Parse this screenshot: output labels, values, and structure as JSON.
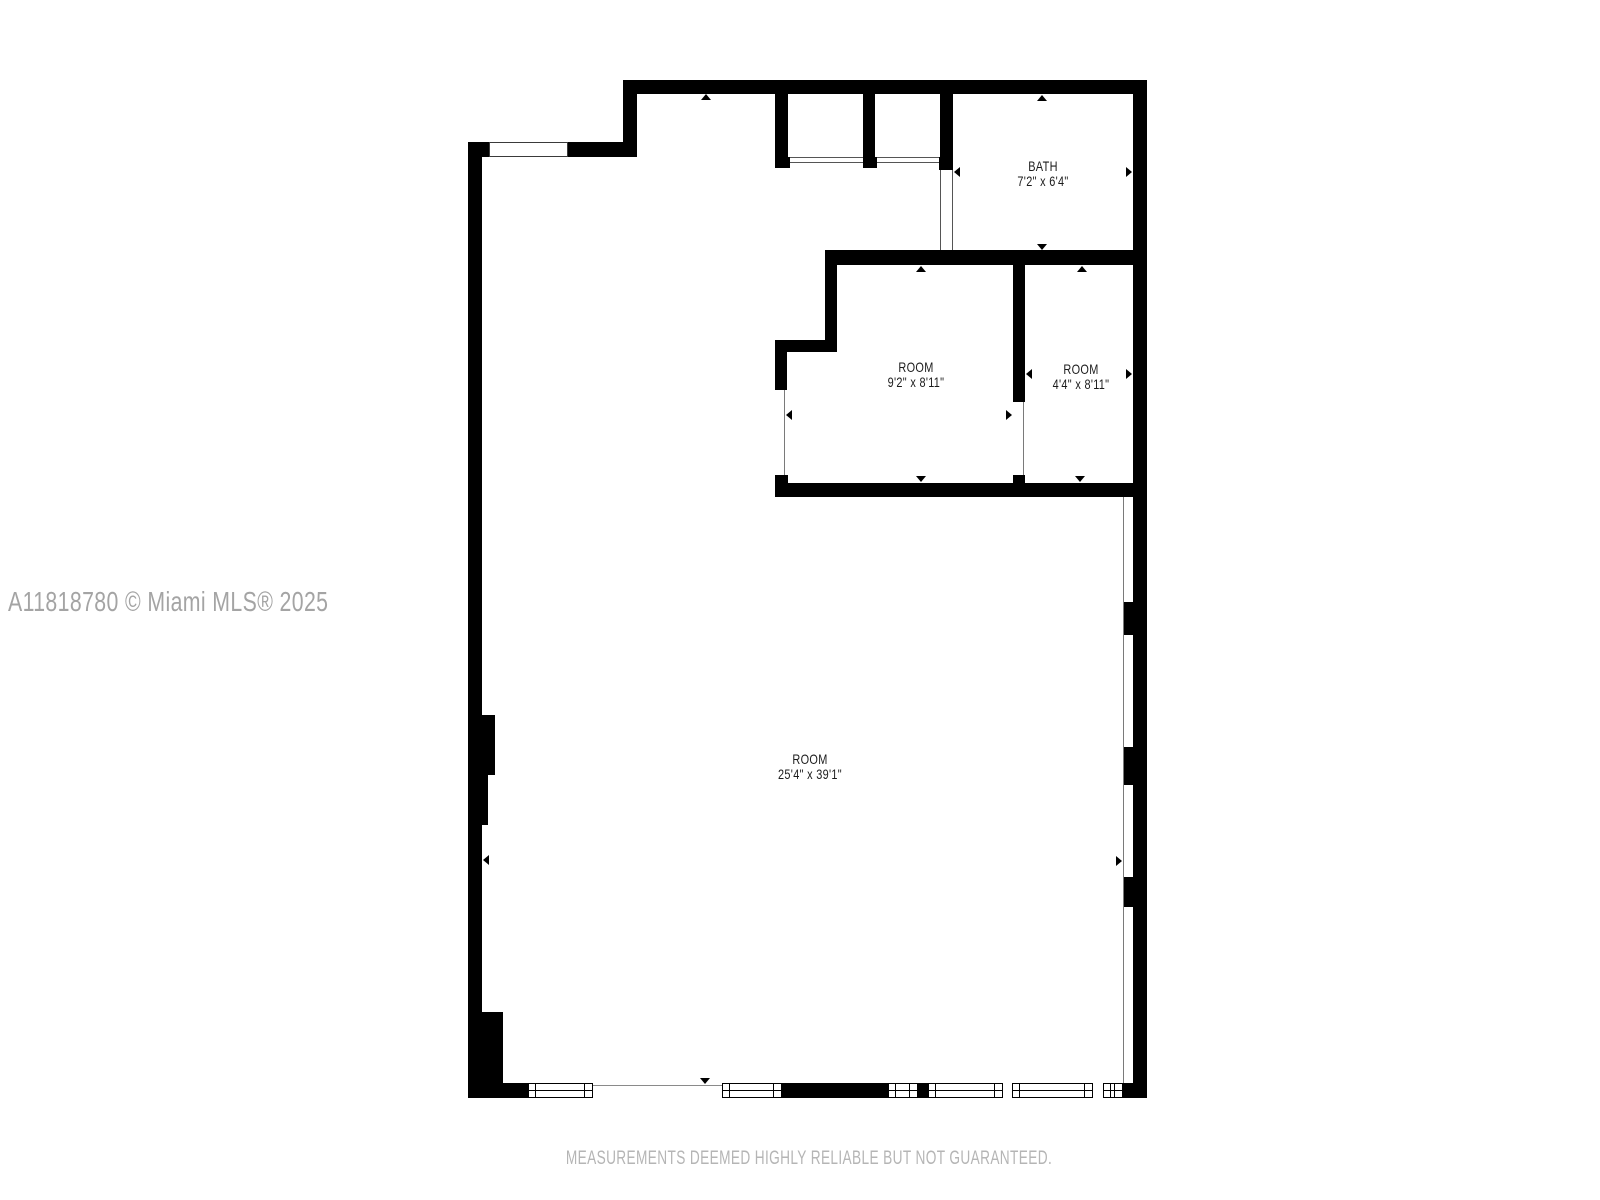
{
  "rooms": [
    {
      "id": "bath",
      "name": "BATH",
      "dims": "7'2\" x 6'4\""
    },
    {
      "id": "room-1",
      "name": "ROOM",
      "dims": "9'2\" x 8'11\""
    },
    {
      "id": "room-2",
      "name": "ROOM",
      "dims": "4'4\" x 8'11\""
    },
    {
      "id": "main-room",
      "name": "ROOM",
      "dims": "25'4\" x 39'1\""
    }
  ],
  "watermark": "A11818780 © Miami MLS® 2025",
  "disclaimer": "MEASUREMENTS DEEMED HIGHLY RELIABLE BUT NOT GUARANTEED.",
  "colors": {
    "wall": "#000000",
    "background": "#ffffff",
    "watermark_text": "#a4a4a4",
    "disclaimer_text": "#b5b5b5",
    "opening_line": "#7a7a7a",
    "label_text": "#1b1b1b"
  }
}
